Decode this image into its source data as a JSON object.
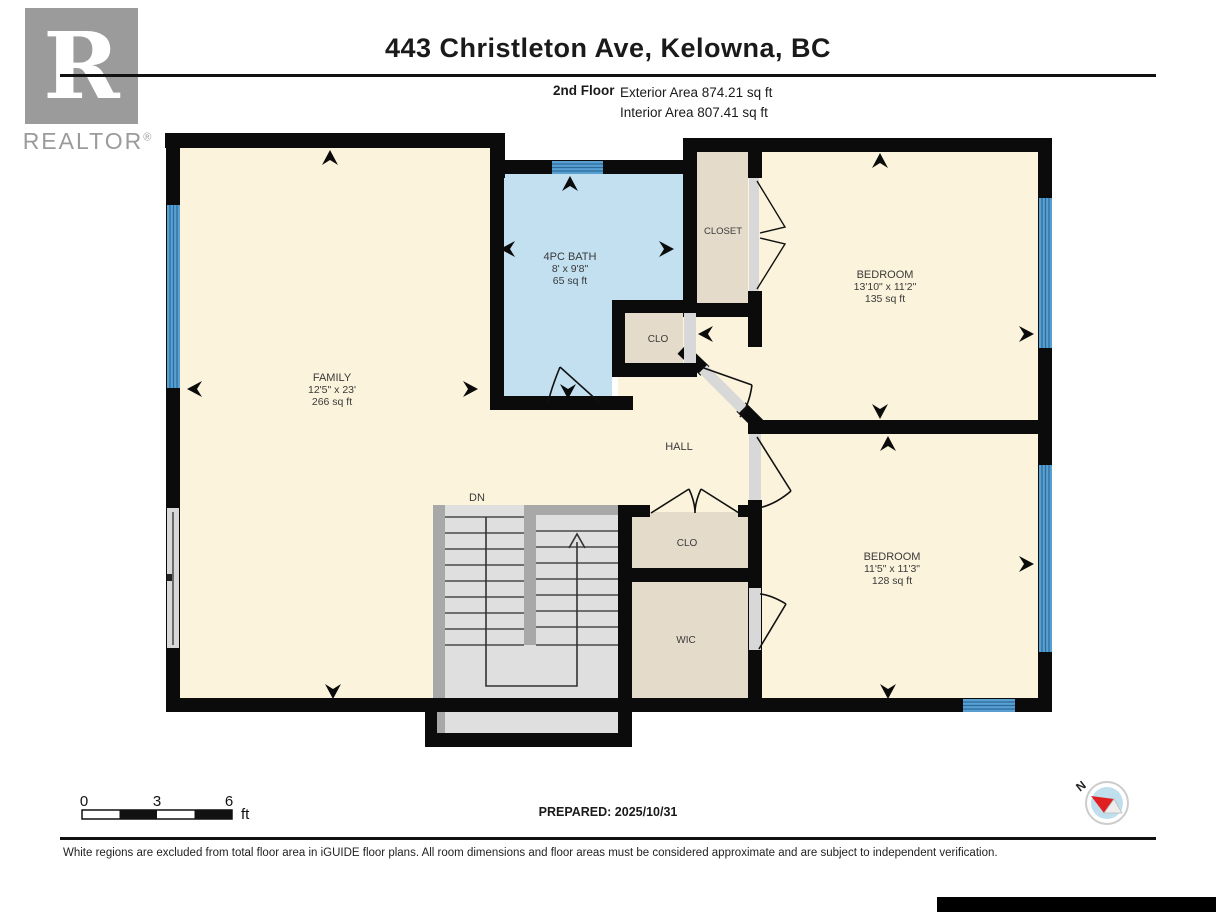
{
  "header": {
    "title": "443 Christleton Ave, Kelowna, BC",
    "floor_label": "2nd Floor",
    "exterior_area": "Exterior Area 874.21 sq ft",
    "interior_area": "Interior Area 807.41 sq ft"
  },
  "logo": {
    "letter": "R",
    "brand": "REALTOR",
    "registered": "®"
  },
  "rooms": {
    "family": {
      "name": "FAMILY",
      "dims": "12'5\" x 23'",
      "area": "266 sq ft"
    },
    "bath": {
      "name": "4PC BATH",
      "dims": "8' x 9'8\"",
      "area": "65 sq ft"
    },
    "closet": {
      "name": "CLOSET"
    },
    "bedroom1": {
      "name": "BEDROOM",
      "dims": "13'10\" x 11'2\"",
      "area": "135 sq ft"
    },
    "clo_bath": {
      "name": "CLO"
    },
    "hall": {
      "name": "HALL"
    },
    "bedroom2": {
      "name": "BEDROOM",
      "dims": "11'5\" x 11'3\"",
      "area": "128 sq ft"
    },
    "clo_hall": {
      "name": "CLO"
    },
    "wic": {
      "name": "WIC"
    },
    "stairs": {
      "label": "DN"
    }
  },
  "scale_bar": {
    "tick0": "0",
    "tick1": "3",
    "tick2": "6",
    "unit": "ft"
  },
  "prepared": "PREPARED: 2025/10/31",
  "compass": {
    "label": "N"
  },
  "disclaimer": "White regions are excluded from total floor area in iGUIDE floor plans. All room dimensions and floor areas must be considered approximate and are subject to independent verification.",
  "colors": {
    "room_cream": "#FBF3DB",
    "bath_blue": "#C2E0F0",
    "closet_beige": "#E4DBCA",
    "wall_black": "#0B0B0B",
    "window_blue": "#58A0D2",
    "window_stripe": "#2B6A9B",
    "stair_gray": "#DFDFDF",
    "stair_strip": "#A8A8A8",
    "opening_gray": "#D8D8D8",
    "compass_red": "#E02020"
  }
}
